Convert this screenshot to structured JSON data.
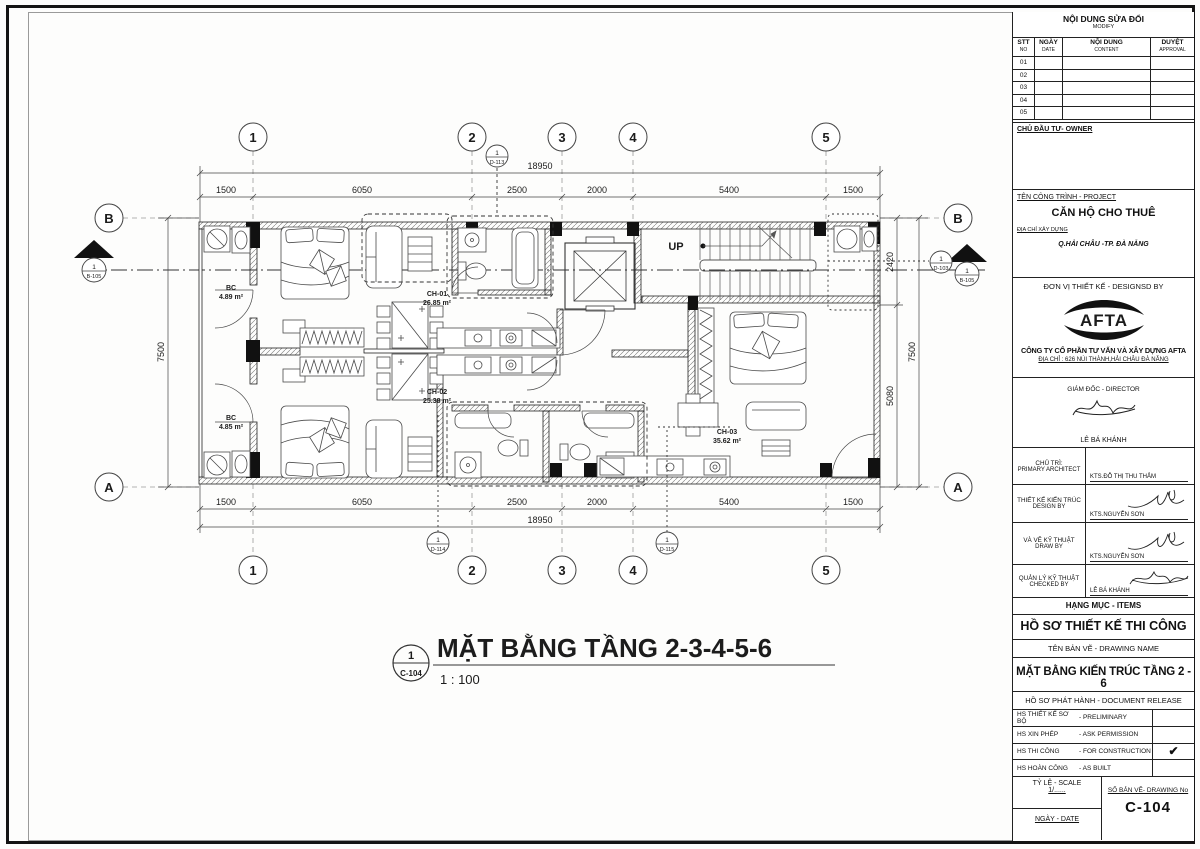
{
  "title_block": {
    "revision": {
      "title": "NỘI DUNG SỬA ĐỔI",
      "subtitle": "MODIFY",
      "col_stt_vi": "STT",
      "col_stt_en": "NO",
      "col_date_vi": "NGÀY",
      "col_date_en": "DATE",
      "col_content_vi": "NỘI DUNG",
      "col_content_en": "CONTENT",
      "col_appr_vi": "DUYỆT",
      "col_appr_en": "APPROVAL",
      "rows": [
        "01",
        "02",
        "03",
        "04",
        "05"
      ]
    },
    "owner_label": "CHỦ ĐẦU TƯ- OWNER",
    "project": {
      "label": "TÊN CÔNG TRÌNH - PROJECT",
      "name": "CĂN HỘ CHO THUÊ",
      "address_label": "ĐỊA CHỈ XÂY DỰNG",
      "address": "Q.HẢI CHÂU -TP. ĐÀ NẴNG"
    },
    "designer": {
      "label": "ĐƠN VỊ THIẾT KẾ - DESIGNSD BY",
      "logo_text": "AFTA",
      "company": "CÔNG TY CỔ PHẦN TƯ VẤN VÀ XÂY DỰNG AFTA",
      "company_address": "ĐỊA CHỈ : 626 NÚI THÀNH,HẢI CHÂU ĐÀ NẴNG"
    },
    "director": {
      "label": "GIÁM ĐỐC - DIRECTOR",
      "name": "LÊ BÁ KHÁNH"
    },
    "staff": [
      {
        "role_vi": "CHỦ TRÌ:",
        "role_en": "PRIMARY ARCHITECT",
        "name": "KTS.ĐỖ THỊ THU THẮM"
      },
      {
        "role_vi": "THIẾT KẾ KIẾN TRÚC",
        "role_en": "DESIGN BY",
        "name": "KTS.NGUYỄN SƠN"
      },
      {
        "role_vi": "VÀ VẼ KỸ THUẬT",
        "role_en": "DRAW BY",
        "name": "KTS.NGUYỄN SƠN"
      },
      {
        "role_vi": "QUẢN LÝ KỸ THUẬT",
        "role_en": "CHECKED BY",
        "name": "LÊ BÁ KHÁNH"
      }
    ],
    "items_label": "HẠNG MỤC - ITEMS",
    "items_value": "HỒ SƠ THIẾT KẾ THI CÔNG",
    "drawing_name_label": "TÊN BẢN VẼ - DRAWING NAME",
    "drawing_name": "MẶT BẰNG KIẾN TRÚC TẦNG 2 - 6",
    "release": {
      "label": "HỒ SƠ PHÁT HÀNH - DOCUMENT RELEASE",
      "check_glyph": "✔",
      "rows": [
        {
          "vi": "HS THIẾT KẾ SƠ BỘ",
          "en": "- PRELIMINARY"
        },
        {
          "vi": "HS XIN PHÉP",
          "en": "- ASK PERMISSION"
        },
        {
          "vi": "HS THI CÔNG",
          "en": "- FOR CONSTRUCTION"
        },
        {
          "vi": "HS HOÀN CÔNG",
          "en": "- AS BUILT"
        }
      ]
    },
    "scale_label": "TỶ LỆ - SCALE",
    "scale_value": "1/......",
    "date_label": "NGÀY - DATE",
    "drawing_no_label": "SỐ BẢN VẼ- DRAWING No",
    "drawing_no": "C-104"
  },
  "plan": {
    "title": {
      "number": "1",
      "sheet": "C-104",
      "text": "MẶT BẰNG TẦNG 2-3-4-5-6",
      "scale": "1 : 100"
    },
    "grid_cols": [
      "1",
      "2",
      "3",
      "4",
      "5"
    ],
    "grid_rows": [
      "B",
      "A"
    ],
    "dims_h": [
      "1500",
      "6050",
      "2500",
      "2000",
      "5400",
      "1500"
    ],
    "dims_h_total": "18950",
    "dims_v_left": "7500",
    "dims_v_right": [
      "2420",
      "5080"
    ],
    "dims_v_right_total": "7500",
    "up_label": "UP",
    "rooms": {
      "bc1": {
        "name": "BC",
        "area": "4.89 m²"
      },
      "bc2": {
        "name": "BC",
        "area": "4.85 m²"
      },
      "ch01": {
        "name": "CH-01",
        "area": "26.85 m²"
      },
      "ch02": {
        "name": "CH-02",
        "area": "25.38 m²"
      },
      "ch03": {
        "name": "CH-03",
        "area": "35.62 m²"
      }
    },
    "callouts": {
      "d113": {
        "num": "1",
        "ref": "D-113"
      },
      "d114": {
        "num": "1",
        "ref": "D-114"
      },
      "d115": {
        "num": "1",
        "ref": "D-115"
      },
      "d103": {
        "num": "1",
        "ref": "D-103"
      },
      "b105": {
        "num": "1",
        "ref": "B-105"
      }
    }
  }
}
